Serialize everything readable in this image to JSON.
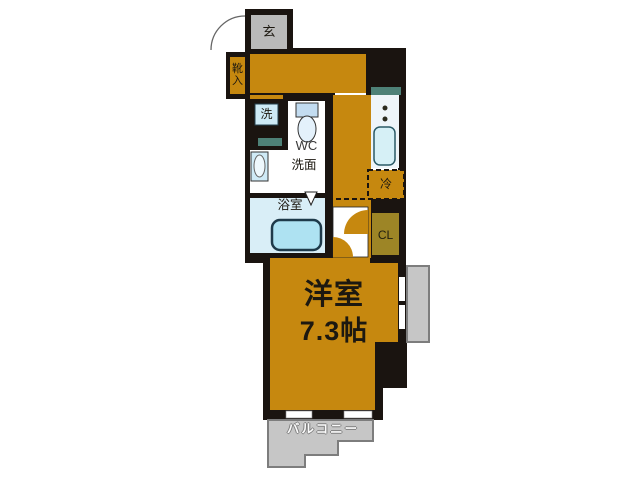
{
  "type": "apartment-floor-plan",
  "colors": {
    "wall": "#1a1410",
    "floor_orange": "#c6880f",
    "entrance_gray": "#bababa",
    "balcony_gray": "#c6c6c6",
    "balcony_border": "#7d7d7d",
    "fixture_blue": "#cdeaf6",
    "bath_floor": "#d9eef7",
    "counter_teal": "#4e8177",
    "closet_olive": "#9d8526",
    "kitchen_counter": "#eef5f9"
  },
  "rooms": {
    "entrance": {
      "label": "玄"
    },
    "shoe_cabinet": {
      "label": "靴入"
    },
    "washer": {
      "label": "洗"
    },
    "toilet": {
      "label": "WC"
    },
    "washroom": {
      "label": "洗面"
    },
    "bathroom": {
      "label": "浴室"
    },
    "refrigerator": {
      "label": "冷"
    },
    "closet": {
      "label": "CL"
    },
    "main_room": {
      "label": "洋室",
      "size": "7.3帖"
    },
    "balcony": {
      "label": "バルコニー"
    }
  }
}
